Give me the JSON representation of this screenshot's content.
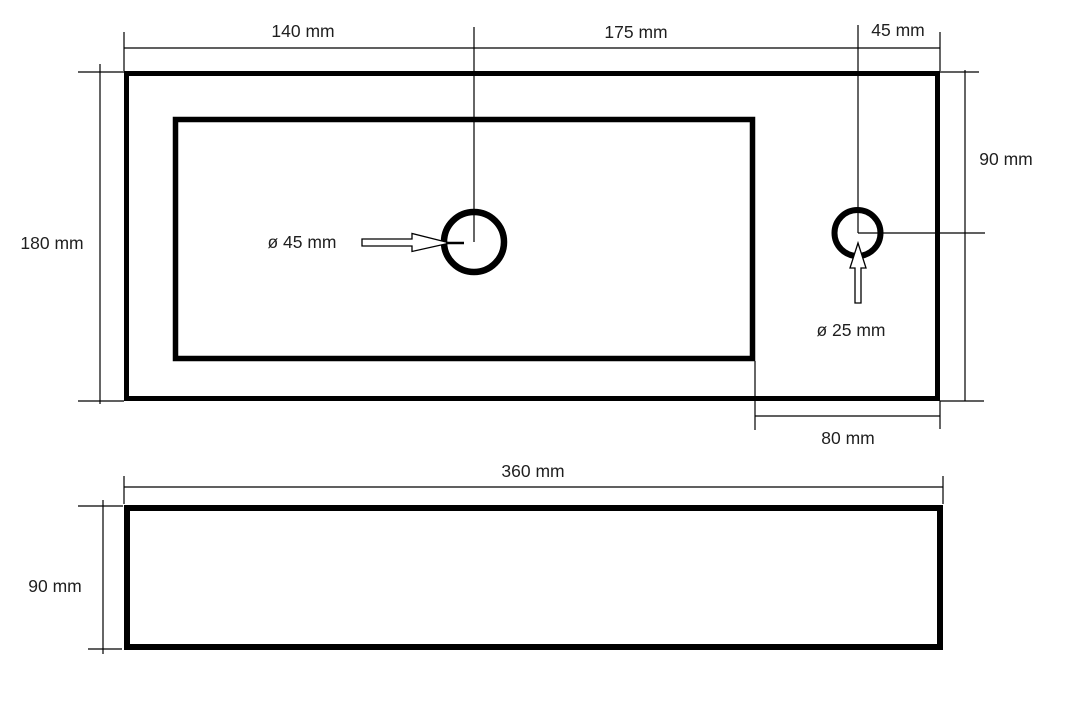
{
  "colors": {
    "background": "#ffffff",
    "line": "#000000",
    "text": "#1f1f1f"
  },
  "top_view": {
    "dim_width_left": "140 mm",
    "dim_width_middle": "175 mm",
    "dim_width_right": "45 mm",
    "dim_height_left": "180 mm",
    "dim_height_right": "90 mm",
    "dim_offset_bottom_right": "80 mm",
    "drain_hole_diameter": "ø 45 mm",
    "tap_hole_diameter": "ø 25 mm"
  },
  "front_view": {
    "dim_width": "360 mm",
    "dim_height": "90 mm"
  }
}
